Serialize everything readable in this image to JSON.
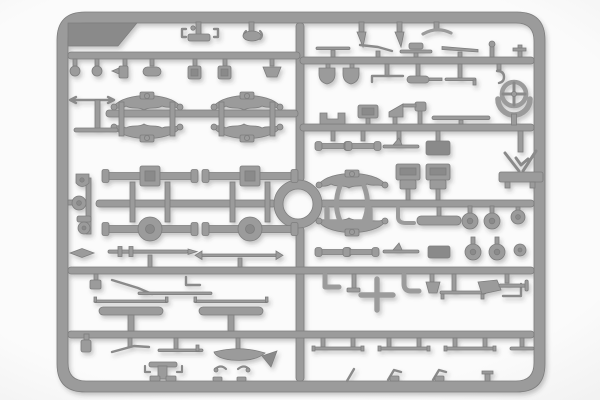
{
  "scene": {
    "type": "product-photo",
    "description": "Top-down photo of a grey injection-moulded model-kit sprue (parts frame) holding many small vehicle parts, on a plain light background",
    "background": {
      "center": "#fbfbfb",
      "edge": "#e2e2e2"
    },
    "plastic": {
      "base": "#9b9b9b",
      "edge": "#7d7d7d",
      "dark_accent": "#8a8a8a",
      "shadow": "rgba(50,50,50,0.30)"
    },
    "sprue": {
      "frame": {
        "left": 57,
        "top": 12,
        "width": 488,
        "height": 380,
        "corner_radius": 28,
        "bar_thickness": 11
      },
      "center_ring": {
        "cx": 298,
        "cy": 204,
        "outer_radius": 24,
        "inner_radius": 15
      },
      "runner_rows_y": [
        52,
        57,
        110,
        124,
        200,
        267,
        331
      ],
      "recognizable_parts": [
        "leaf-springs",
        "front-axles",
        "rear-axles-with-differential",
        "steering-wheel",
        "seat-boxes",
        "wheels",
        "running-boards",
        "tie-rods",
        "exhaust-elbows",
        "shovel",
        "cross-frame",
        "brackets",
        "pins",
        "hooks"
      ]
    }
  }
}
